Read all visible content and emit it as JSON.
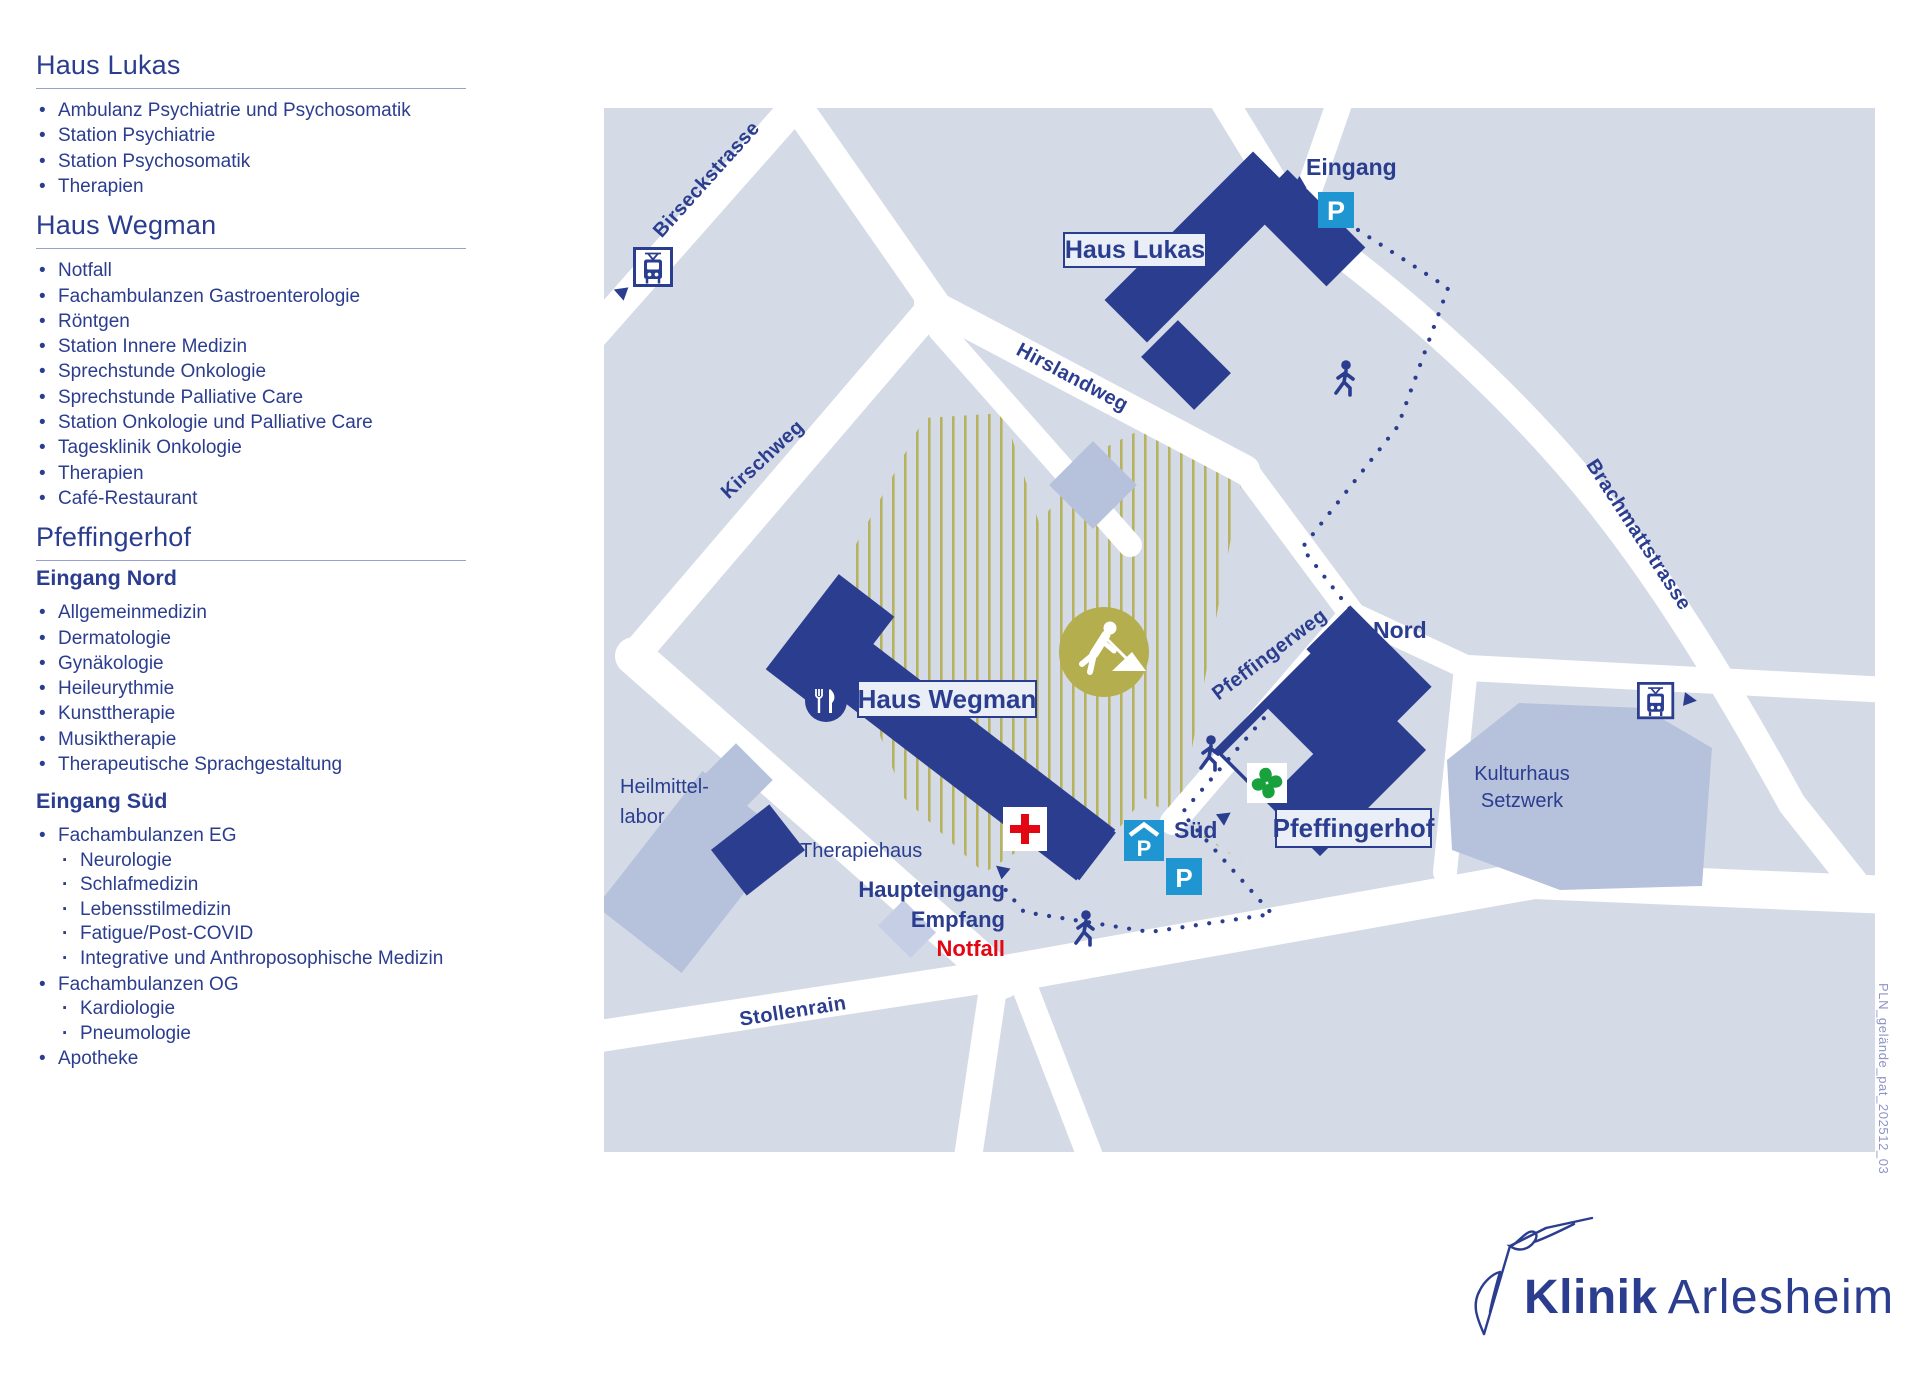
{
  "sidebar": {
    "sections": [
      {
        "title": "Haus Lukas",
        "groups": [
          {
            "items": [
              {
                "label": "Ambulanz Psychiatrie und Psychosomatik"
              },
              {
                "label": "Station Psychiatrie"
              },
              {
                "label": "Station Psychosomatik"
              },
              {
                "label": "Therapien"
              }
            ]
          }
        ]
      },
      {
        "title": "Haus Wegman",
        "groups": [
          {
            "items": [
              {
                "label": "Notfall"
              },
              {
                "label": "Fachambulanzen Gastroenterologie"
              },
              {
                "label": "Röntgen"
              },
              {
                "label": "Station Innere Medizin"
              },
              {
                "label": "Sprechstunde Onkologie"
              },
              {
                "label": "Sprechstunde Palliative Care"
              },
              {
                "label": "Station Onkologie und Palliative Care"
              },
              {
                "label": "Tagesklinik Onkologie"
              },
              {
                "label": "Therapien"
              },
              {
                "label": "Café-Restaurant"
              }
            ]
          }
        ]
      },
      {
        "title": "Pfeffingerhof",
        "groups": [
          {
            "heading": "Eingang Nord",
            "items": [
              {
                "label": "Allgemeinmedizin"
              },
              {
                "label": "Dermatologie"
              },
              {
                "label": "Gynäkologie"
              },
              {
                "label": "Heileurythmie"
              },
              {
                "label": "Kunsttherapie"
              },
              {
                "label": "Musiktherapie"
              },
              {
                "label": "Therapeutische Sprachgestaltung"
              }
            ]
          },
          {
            "heading": "Eingang Süd",
            "items": [
              {
                "label": "Fachambulanzen EG",
                "sub": [
                  "Neurologie",
                  "Schlafmedizin",
                  "Lebensstilmedizin",
                  "Fatigue/Post-COVID",
                  "Integrative und Anthroposophische Medizin"
                ]
              },
              {
                "label": "Fachambulanzen OG",
                "sub": [
                  "Kardiologie",
                  "Pneumologie"
                ]
              },
              {
                "label": "Apotheke"
              }
            ]
          }
        ]
      }
    ]
  },
  "map": {
    "parking_letter": "P",
    "street_labels": {
      "birseckstrasse": "Birseckstrasse",
      "hirslandweg": "Hirslandweg",
      "kirschweg": "Kirschweg",
      "pfeffingerweg": "Pfeffingerweg",
      "brachmattstrasse": "Brachmattstrasse",
      "stollenrain": "Stollenrain"
    },
    "building_labels": {
      "haus_lukas": "Haus Lukas",
      "haus_wegman": "Haus Wegman",
      "pfeffingerhof": "Pfeffingerhof",
      "kulturhaus_line1": "Kulturhaus",
      "kulturhaus_line2": "Setzwerk",
      "heilmittellabor_line1": "Heilmittel-",
      "heilmittellabor_line2": "labor",
      "therapiehaus": "Therapiehaus"
    },
    "poi_labels": {
      "eingang": "Eingang",
      "nord": "Nord",
      "sued": "Süd",
      "haupteingang": "Haupteingang",
      "empfang": "Empfang",
      "notfall": "Notfall"
    }
  },
  "logo": {
    "brand_bold": "Klinik",
    "brand_light": "Arlesheim"
  },
  "watermark": "PLN_gelände_pat_202512_03",
  "colors": {
    "navy": "#2b3d8f",
    "map_bg": "#d4dbe7",
    "periwinkle": "#b6c1dc",
    "periwinkle_light": "#c5cee4",
    "label_box_bg": "#eaeef7",
    "olive": "#b4ae4e",
    "p_blue": "#1f96d2",
    "red": "#e30613",
    "green": "#18a13c",
    "watermark_color": "#8d93c4",
    "rule": "#98a0cd"
  }
}
